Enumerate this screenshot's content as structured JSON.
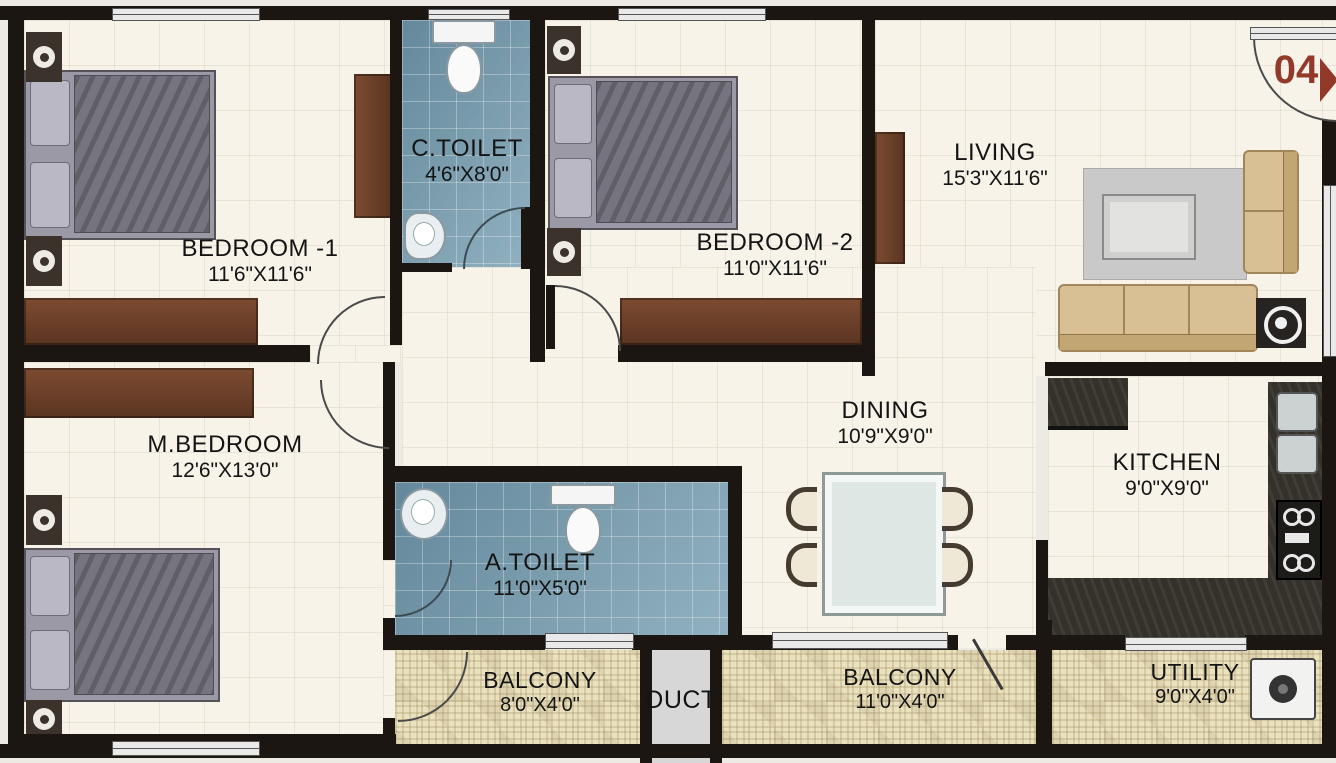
{
  "unit": {
    "number": "04"
  },
  "rooms": {
    "bedroom1": {
      "name": "BEDROOM -1",
      "size": "11'6\"X11'6\""
    },
    "ctoilet": {
      "name": "C.TOILET",
      "size": "4'6\"X8'0\""
    },
    "bedroom2": {
      "name": "BEDROOM -2",
      "size": "11'0\"X11'6\""
    },
    "living": {
      "name": "LIVING",
      "size": "15'3\"X11'6\""
    },
    "mbedroom": {
      "name": "M.BEDROOM",
      "size": "12'6\"X13'0\""
    },
    "dining": {
      "name": "DINING",
      "size": "10'9\"X9'0\""
    },
    "kitchen": {
      "name": "KITCHEN",
      "size": "9'0\"X9'0\""
    },
    "atoilet": {
      "name": "A.TOILET",
      "size": "11'0\"X5'0\""
    },
    "balcony1": {
      "name": "BALCONY",
      "size": "8'0\"X4'0\""
    },
    "duct": {
      "name": "DUCT"
    },
    "balcony2": {
      "name": "BALCONY",
      "size": "11'0\"X4'0\""
    },
    "utility": {
      "name": "UTILITY",
      "size": "9'0\"X4'0\""
    }
  },
  "colors": {
    "wall": "#1b1611",
    "floor": "#f7f3e9",
    "toilet_floor": "#7ea4b6",
    "balcony_floor": "#eae1bf",
    "duct_floor": "#d7d7d7",
    "wood": "#6e4630",
    "unit_accent": "#93392a"
  }
}
